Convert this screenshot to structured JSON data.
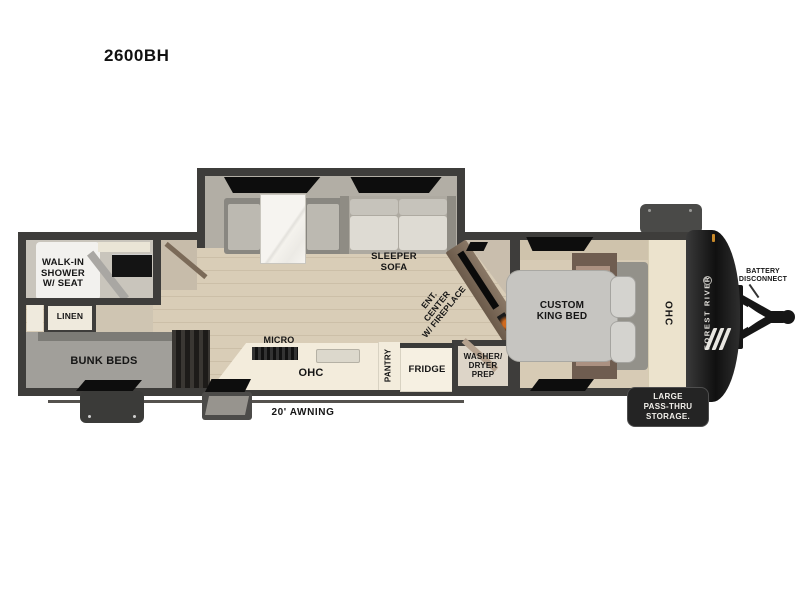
{
  "title": "2600BH",
  "floorplan": {
    "labels": {
      "shower": "WALK-IN\nSHOWER\nW/ SEAT",
      "linen": "LINEN",
      "bunk_beds": "BUNK BEDS",
      "sleeper_sofa": "SLEEPER\nSOFA",
      "micro": "MICRO",
      "ohc_kitchen": "OHC",
      "pantry": "PANTRY",
      "fridge": "FRIDGE",
      "ent_center": "ENT.\nCENTER\nW/ FIREPLACE",
      "washer_dryer": "WASHER/\nDRYER\nPREP",
      "king_bed": "CUSTOM\nKING BED",
      "ohc_bedroom": "OHC",
      "brand": "FOREST RIVER",
      "battery": "BATTERY\nDISCONNECT",
      "pass_thru_storage": "LARGE\nPASS-THRU\nSTORAGE.",
      "awning": "20' AWNING"
    },
    "colors": {
      "wall": "#3e3d3b",
      "wood_floor": "#d9cdb7",
      "slide_floor": "#b2aea5",
      "bath_floor": "#c9c5bc",
      "bunk_floor": "#a19f9a",
      "counter_white": "#f3ecdc",
      "cabinet_cream": "#ece3cd",
      "front_cap": "#1a1a1a",
      "badge": "#242424",
      "marker_light": "#c98a2a"
    }
  }
}
